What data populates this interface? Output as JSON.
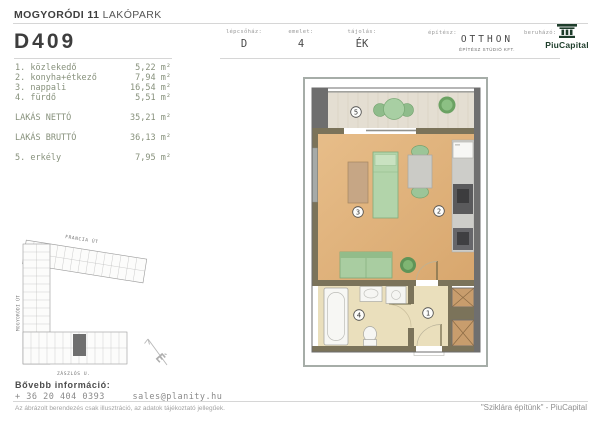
{
  "header": {
    "project_bold": "MOGYORÓDI 11",
    "project_rest": "LAKÓPARK",
    "unit_id": "D409",
    "fields": [
      {
        "label": "lépcsőház:",
        "value": "D"
      },
      {
        "label": "emelet:",
        "value": "4"
      },
      {
        "label": "tájolás:",
        "value": "ÉK"
      }
    ],
    "architect_label": "építész:",
    "architect_name": "OTTHON",
    "architect_sub": "ÉPÍTÉSZ STÚDIÓ KFT.",
    "developer_label": "beruházó:",
    "developer_name": "PiuCapital"
  },
  "rooms": {
    "items": [
      {
        "num": "1.",
        "name": "közlekedő",
        "area": "5,22 m²"
      },
      {
        "num": "2.",
        "name": "konyha+étkező",
        "area": "7,94 m²"
      },
      {
        "num": "3.",
        "name": "nappali",
        "area": "16,54 m²"
      },
      {
        "num": "4.",
        "name": "fürdő",
        "area": "5,51 m²"
      }
    ],
    "net_label": "LAKÁS NETTÓ",
    "net_value": "35,21 m²",
    "gross_label": "LAKÁS BRUTTÓ",
    "gross_value": "36,13 m²",
    "balcony_num": "5.",
    "balcony_name": "erkély",
    "balcony_area": "7,95 m²"
  },
  "floor_plan": {
    "numbers": [
      "1",
      "2",
      "3",
      "4",
      "5"
    ]
  },
  "site_plan": {
    "street_top": "FRANCIA ÚT",
    "street_left": "MOGYORÓDI ÚT",
    "street_bottom": "ZÁSZLÓS U.",
    "north_label": "É"
  },
  "footer": {
    "info_label": "Bővebb információ:",
    "phone": "+ 36 20 404 0393",
    "email": "sales@planity.hu",
    "disclaimer": "Az ábrázolt berendezés csak illusztráció, az adatok tájékoztató jellegűek.",
    "tagline": "\"Sziklára építünk\" - PiuCapital"
  },
  "colors": {
    "heading_text": "#3f3f3f",
    "room_list_text": "#87917c",
    "wood_floor": "#e0b27a",
    "tile_floor": "#eadfbc",
    "balcony_floor": "#e4ded2",
    "wall_interior": "#7b735a",
    "wall_exterior": "#6e6e6e",
    "furniture_green": "#a9cda1",
    "shaft_brown": "#c89d6d",
    "brand_green": "#1e3d2b"
  }
}
